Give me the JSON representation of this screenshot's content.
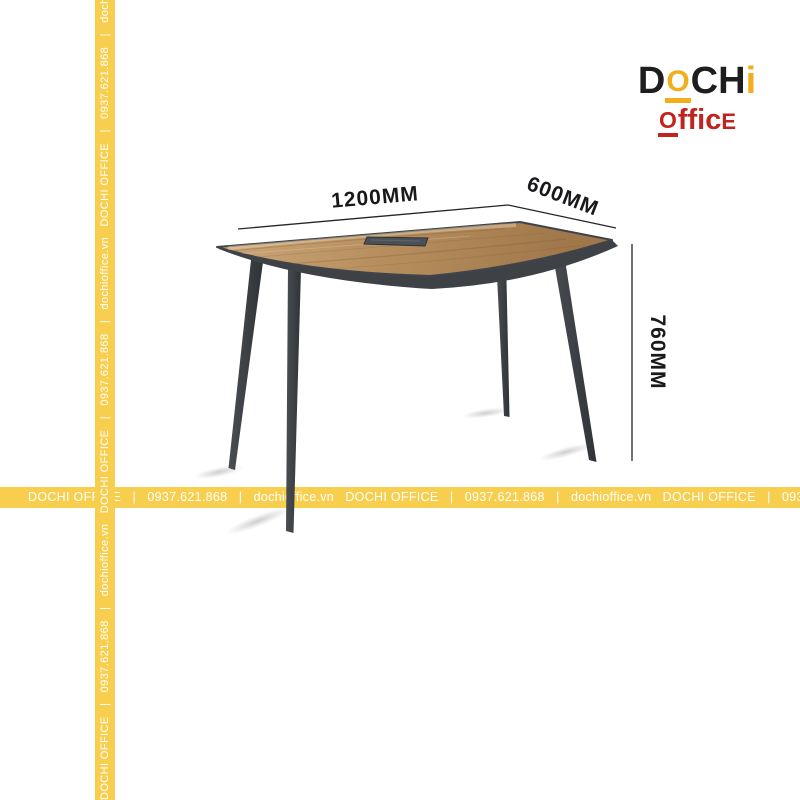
{
  "logo": {
    "line1": {
      "d": "D",
      "o": "O",
      "c": "C",
      "h": "H",
      "i": "i"
    },
    "line2": {
      "o": "O",
      "ffic": "ffic",
      "e": "E"
    },
    "colors": {
      "gold": "#F2AF1D",
      "red": "#C1231E",
      "dark": "#1E1E1E"
    }
  },
  "dimensions": {
    "width_label": "1200MM",
    "depth_label": "600MM",
    "height_label": "760MM"
  },
  "watermark": {
    "brand": "DOCHI OFFICE",
    "phone": "0937.621.868",
    "website": "dochioffice.vn",
    "repeat_unit": "DOCHI OFFICE   |   0937.621.868   |   dochioffice.vn   ",
    "strip_color": "#F8CE4F",
    "text_color": "#FFFFFF"
  },
  "table": {
    "top_color_light": "#C9A274",
    "top_color_dark": "#9F774A",
    "frame_color": "#3E4247"
  }
}
